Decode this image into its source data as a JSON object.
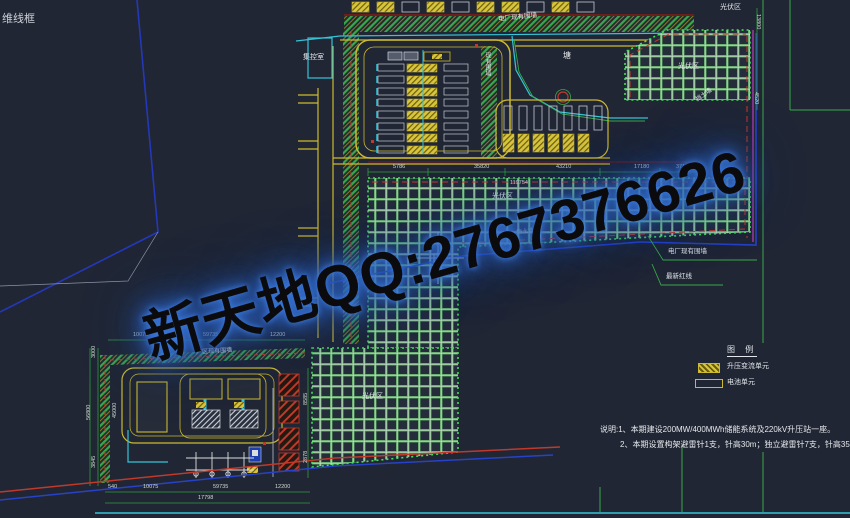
{
  "viewport": {
    "style_label": "维线框"
  },
  "watermark": {
    "text": "新天地QQ:2767376626",
    "glow_color": "#2f6fd6"
  },
  "labels": {
    "control_room": "集控室",
    "pond": "塘",
    "pv_area": "光伏区",
    "wall_top": "电厂现有围墙",
    "wall_vertical": "现有围墙",
    "retaining_wall": "挡土墙",
    "plant_wall": "厂区现有围墙",
    "leader_wall": "电厂现有围墙",
    "leader_redline": "最新红线"
  },
  "legend": {
    "title": "图 例",
    "items": [
      {
        "symbol": "step-up-converter-unit-swatch",
        "label": "升压变流单元"
      },
      {
        "symbol": "battery-unit-swatch",
        "label": "电池单元"
      }
    ]
  },
  "notes": {
    "line1": "说明:1、本期建设200MW/400MWh储能系统及220kV升压站一座。",
    "line2": "2、本期设置构架避雷针1支，针高30m；独立避雷针7支，针高35m。"
  },
  "dims": {
    "band_top": [
      "5786",
      "35820",
      "43210",
      "17180",
      "3710"
    ],
    "band_top_total": "119754",
    "band_right": [
      "13800",
      "4520"
    ],
    "sub_top": [
      "10075",
      "59735",
      "12200"
    ],
    "sub_bottom": [
      "540",
      "10075",
      "59735",
      "12200"
    ],
    "sub_bottom_total": "17798",
    "sub_left": [
      "3000",
      "56800",
      "3845"
    ],
    "sub_left_inner": "45000",
    "sub_right": [
      "8585",
      "2878"
    ]
  },
  "colors": {
    "background": "#202634",
    "road_yellow": "#cdb92f",
    "hatch_green": "#3aa84a",
    "grid_green": "#55a35c",
    "cyan": "#35c4d8",
    "red": "#c0392b",
    "dark_red": "#6e1d1d",
    "boundary_blue": "#2742c8",
    "magenta": "#c23cc2",
    "watermark_glow": "#2f6fd6"
  }
}
